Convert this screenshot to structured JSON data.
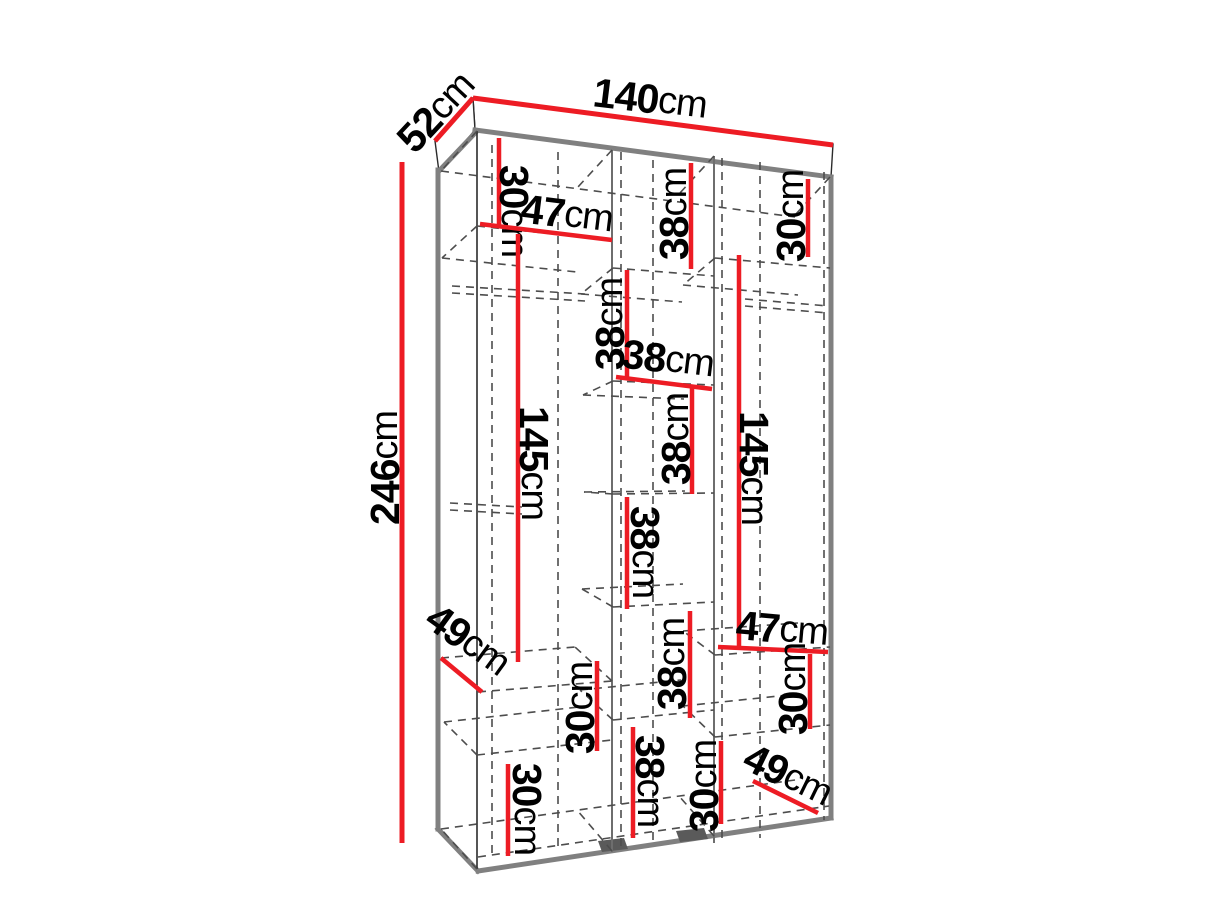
{
  "diagram": {
    "type": "furniture-dimension-drawing",
    "subject": "three-section wardrobe with shelves",
    "unit": "cm"
  },
  "colors": {
    "dimension_line": "#ed1c24",
    "visible_edge": "#808080",
    "hidden_edge": "#4d4d4d",
    "label_text": "#000000",
    "background": "#ffffff"
  },
  "overall_dimensions": {
    "width": "140cm",
    "depth": "52cm",
    "height": "246cm"
  },
  "annotations": [
    {
      "name": "overall-width-140",
      "num": "140",
      "unit": "cm",
      "x": 650,
      "y": 99,
      "rot": 7,
      "x1": 473,
      "y1": 98,
      "x2": 833,
      "y2": 145,
      "w": 5
    },
    {
      "name": "overall-depth-52",
      "num": "52",
      "unit": "cm",
      "x": 436,
      "y": 112,
      "rot": -47,
      "x1": 435,
      "y1": 141,
      "x2": 473,
      "y2": 98,
      "w": 5
    },
    {
      "name": "overall-height-246",
      "num": "246",
      "unit": "cm",
      "x": 385,
      "y": 468,
      "rot": -90,
      "x1": 402,
      "y1": 162,
      "x2": 402,
      "y2": 843,
      "w": 5
    },
    {
      "name": "left-top-30",
      "num": "30",
      "unit": "cm",
      "x": 514,
      "y": 211,
      "rot": 90,
      "x1": 499,
      "y1": 138,
      "x2": 499,
      "y2": 228,
      "w": 4.5
    },
    {
      "name": "left-shelf-47",
      "num": "47",
      "unit": "cm",
      "x": 567,
      "y": 214,
      "rot": 7,
      "x1": 480,
      "y1": 224,
      "x2": 612,
      "y2": 240,
      "w": 4.5
    },
    {
      "name": "left-hanging-145",
      "num": "145",
      "unit": "cm",
      "x": 534,
      "y": 463,
      "rot": 90,
      "x1": 518,
      "y1": 234,
      "x2": 518,
      "y2": 662,
      "w": 4.5
    },
    {
      "name": "left-depth-49",
      "num": "49",
      "unit": "cm",
      "x": 468,
      "y": 640,
      "rot": 36,
      "x1": 441,
      "y1": 658,
      "x2": 482,
      "y2": 692,
      "w": 4.5
    },
    {
      "name": "left-mid-30",
      "num": "30",
      "unit": "cm",
      "x": 580,
      "y": 708,
      "rot": -90,
      "x1": 597,
      "y1": 661,
      "x2": 597,
      "y2": 751,
      "w": 4.5
    },
    {
      "name": "left-bottom-30",
      "num": "30",
      "unit": "cm",
      "x": 527,
      "y": 809,
      "rot": 90,
      "x1": 508,
      "y1": 764,
      "x2": 508,
      "y2": 856,
      "w": 4.5
    },
    {
      "name": "middle-38-1",
      "num": "38",
      "unit": "cm",
      "x": 674,
      "y": 214,
      "rot": -90,
      "x1": 691,
      "y1": 163,
      "x2": 691,
      "y2": 269,
      "w": 4.5
    },
    {
      "name": "middle-38-2",
      "num": "38",
      "unit": "cm",
      "x": 610,
      "y": 324,
      "rot": -90,
      "x1": 627,
      "y1": 270,
      "x2": 627,
      "y2": 379,
      "w": 4.5
    },
    {
      "name": "middle-38-width",
      "num": "38",
      "unit": "cm",
      "x": 668,
      "y": 359,
      "rot": 7,
      "x1": 616,
      "y1": 377,
      "x2": 712,
      "y2": 389,
      "w": 4.5
    },
    {
      "name": "middle-38-3",
      "num": "38",
      "unit": "cm",
      "x": 676,
      "y": 439,
      "rot": -90,
      "x1": 692,
      "y1": 387,
      "x2": 692,
      "y2": 494,
      "w": 4.5
    },
    {
      "name": "middle-38-4",
      "num": "38",
      "unit": "cm",
      "x": 645,
      "y": 552,
      "rot": 90,
      "x1": 627,
      "y1": 497,
      "x2": 627,
      "y2": 609,
      "w": 4.5
    },
    {
      "name": "middle-38-5",
      "num": "38",
      "unit": "cm",
      "x": 672,
      "y": 664,
      "rot": -90,
      "x1": 690,
      "y1": 611,
      "x2": 690,
      "y2": 718,
      "w": 4.5
    },
    {
      "name": "middle-38-6",
      "num": "38",
      "unit": "cm",
      "x": 650,
      "y": 781,
      "rot": 90,
      "x1": 633,
      "y1": 727,
      "x2": 633,
      "y2": 838,
      "w": 4.5
    },
    {
      "name": "right-top-30",
      "num": "30",
      "unit": "cm",
      "x": 791,
      "y": 216,
      "rot": -90,
      "x1": 808,
      "y1": 179,
      "x2": 808,
      "y2": 257,
      "w": 4.5
    },
    {
      "name": "right-hanging-145",
      "num": "145",
      "unit": "cm",
      "x": 754,
      "y": 468,
      "rot": 90,
      "x1": 739,
      "y1": 255,
      "x2": 739,
      "y2": 649,
      "w": 4.5
    },
    {
      "name": "right-shelf-47",
      "num": "47",
      "unit": "cm",
      "x": 782,
      "y": 629,
      "rot": 5,
      "x1": 718,
      "y1": 647,
      "x2": 828,
      "y2": 652,
      "w": 4.5
    },
    {
      "name": "right-mid-30",
      "num": "30",
      "unit": "cm",
      "x": 793,
      "y": 689,
      "rot": -90,
      "x1": 810,
      "y1": 654,
      "x2": 810,
      "y2": 729,
      "w": 4.5
    },
    {
      "name": "right-bottom-30",
      "num": "30",
      "unit": "cm",
      "x": 704,
      "y": 786,
      "rot": -90,
      "x1": 721,
      "y1": 741,
      "x2": 721,
      "y2": 824,
      "w": 4.5
    },
    {
      "name": "right-depth-49",
      "num": "49",
      "unit": "cm",
      "x": 788,
      "y": 775,
      "rot": 26,
      "x1": 753,
      "y1": 781,
      "x2": 818,
      "y2": 813,
      "w": 4.5
    }
  ]
}
